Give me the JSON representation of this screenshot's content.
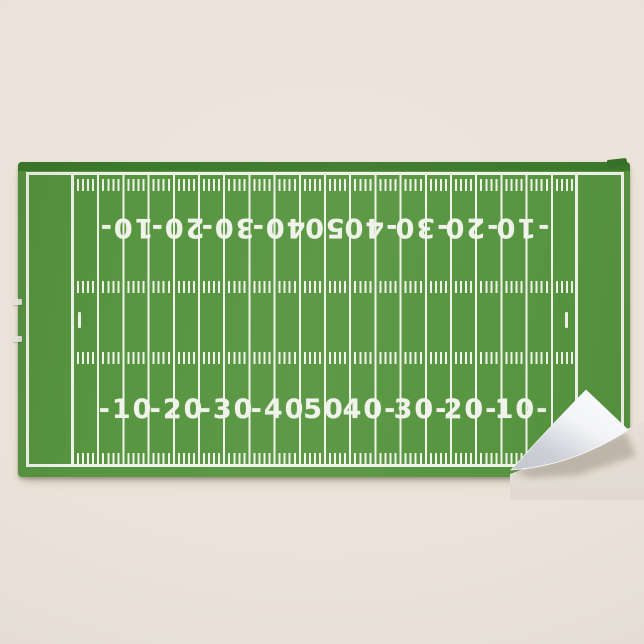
{
  "colors": {
    "bg": "#ebe3d9",
    "field-green": "#579540",
    "hem-green": "#3d7a2c",
    "line-white": "#f0f3e9",
    "fold-white": "#fbfcfe",
    "fold-shade": "#cdd0d7"
  },
  "field": {
    "numbers_top": [
      "10-",
      "20-",
      "30-",
      "40-",
      "50",
      "-40",
      "-30",
      "-20",
      "-10"
    ],
    "numbers_bottom": [
      "-10",
      "-20",
      "-30",
      "-40",
      "50",
      "40-",
      "30-",
      "20-",
      "10-"
    ]
  }
}
